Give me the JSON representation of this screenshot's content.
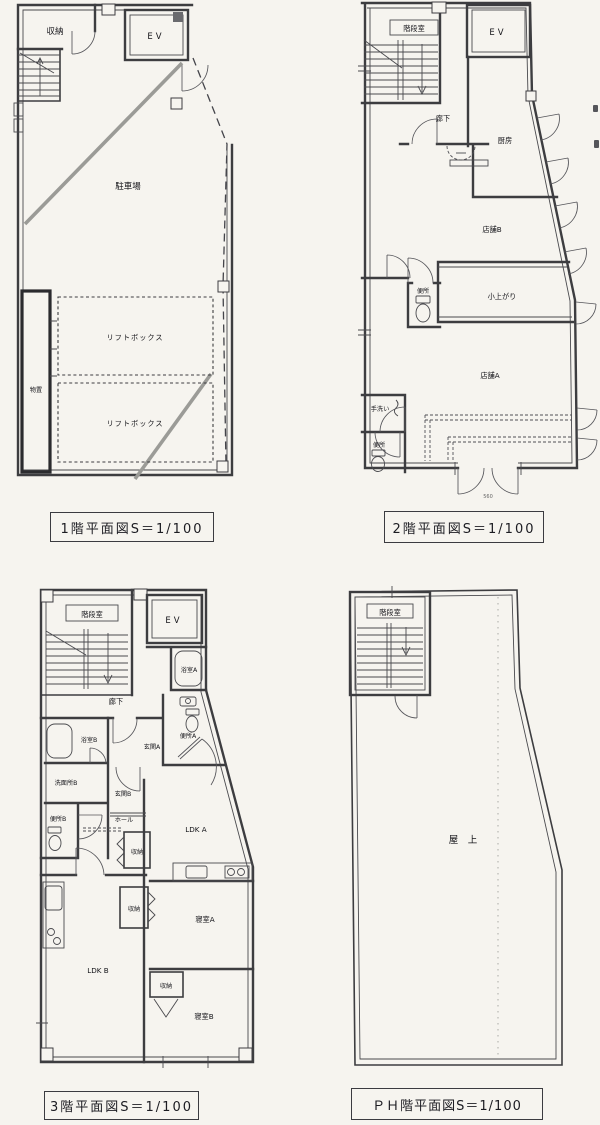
{
  "sheet": {
    "title": "floor-plan-sheet",
    "colors": {
      "paper": "#f6f4ef",
      "line": "#3d3d40",
      "ramp_gray": "#9b9b97"
    }
  },
  "floors": {
    "f1": {
      "caption": "1階平面図S＝1/100",
      "labels": {
        "storage": "収納",
        "elevator": "EV",
        "parking": "駐車場",
        "liftbox_a": "リフトボックス",
        "liftbox_b": "リフトボックス",
        "shed": "物置"
      }
    },
    "f2": {
      "caption": "2階平面図S＝1/100",
      "labels": {
        "stairwell": "階段室",
        "elevator": "EV",
        "corridor": "廊下",
        "kitchen": "厨房",
        "shop_b": "店舗B",
        "toilet_upper": "便所",
        "koagari": "小上がり",
        "shop_a": "店舗A",
        "handwash": "手洗い",
        "toilet_lower": "便所",
        "entrance_dim": "560"
      }
    },
    "f3": {
      "caption": "3階平面図S＝1/100",
      "labels": {
        "stairwell": "階段室",
        "elevator": "EV",
        "bath_a": "浴室A",
        "corridor": "廊下",
        "toilet_a": "便所A",
        "entrance_a": "玄関A",
        "bath_b": "浴室B",
        "washroom_b": "洗面所B",
        "entrance_b": "玄関B",
        "toilet_b": "便所B",
        "hall": "ホール",
        "ldk_a": "LDK A",
        "closet_1": "収納",
        "closet_2": "収納",
        "closet_3": "収納",
        "bedroom_a": "寝室A",
        "ldk_b": "LDK B",
        "bedroom_b": "寝室B"
      }
    },
    "f4": {
      "caption": "ＰＨ階平面図S＝1/100",
      "labels": {
        "stairwell": "階段室",
        "rooftop": "屋　上"
      }
    }
  }
}
